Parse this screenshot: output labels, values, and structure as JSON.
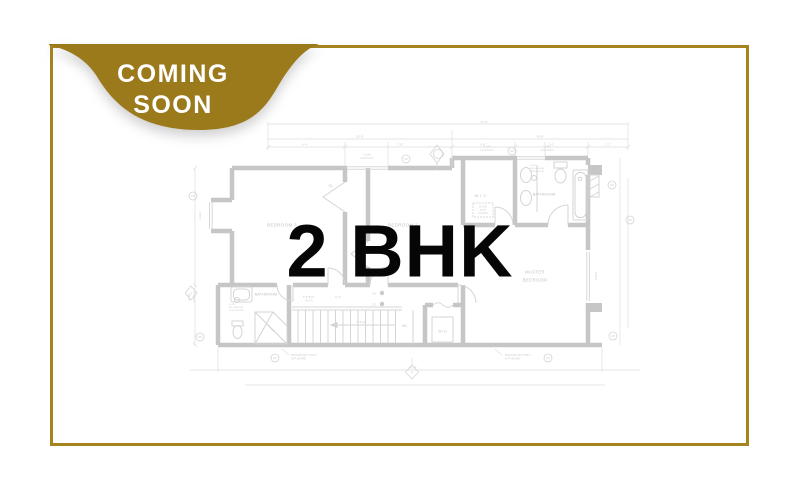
{
  "badge": {
    "line1": "COMING",
    "line2": "SOON",
    "fill": "#9b7a1b",
    "text_color": "#ffffff"
  },
  "frame": {
    "border_color": "#a5831e"
  },
  "overlay": {
    "title": "2 BHK",
    "color": "#060606"
  },
  "floorplan": {
    "ink_wall": "#c6c6c6",
    "ink_thin": "#dedede",
    "labels": {
      "bedroom3": "BEDROOM 3",
      "bedroom2": "BEDROOM 2",
      "closet": "CL",
      "wic": "W. I. C.",
      "bathroom_top": "BATHROOM",
      "bathroom_bottom": "BATHROOM",
      "master_line1": "MASTER",
      "master_line2": "BEDROOM",
      "wd": "W / D",
      "dn": "DN",
      "sa": "SA",
      "co": "CO",
      "shower": "SHOWER",
      "attic_line1": "22\"x30\"",
      "attic_line2": "ATTIC",
      "attic_line3": "ACCESS",
      "note_line1": "NOTE:",
      "note_line2": "MECHANICAL",
      "note_line3": "VENTILATION",
      "gyp_line1": "PROVIDE 5/8\" TYPE X",
      "gyp_line2": "GYP. BOARD",
      "header_line1": "2-2x8+",
      "header_line2": "L4x3.5x1/4",
      "stair_box": "5'-8\" BOX",
      "stair_flat": "(FLAT)",
      "stair_run": "11'-6\"",
      "stair_arrow": "8'-6 3/4\""
    },
    "dims": {
      "total_top": "41'-6\"",
      "top_left": "26'-8\"",
      "top_right": "16'-8\"",
      "seg1": "4'-4\"",
      "seg2": "7'-10\"",
      "seg3": "6'-4\"",
      "seg4": "3'-4\"",
      "seg5": "2'-2\"",
      "left_window": "2-2x10",
      "right_window": "2-2x10",
      "total_bottom": "41'-6\""
    },
    "symbols": {
      "w3": "W3",
      "w4": "W4",
      "a": "A",
      "b": "B"
    }
  }
}
